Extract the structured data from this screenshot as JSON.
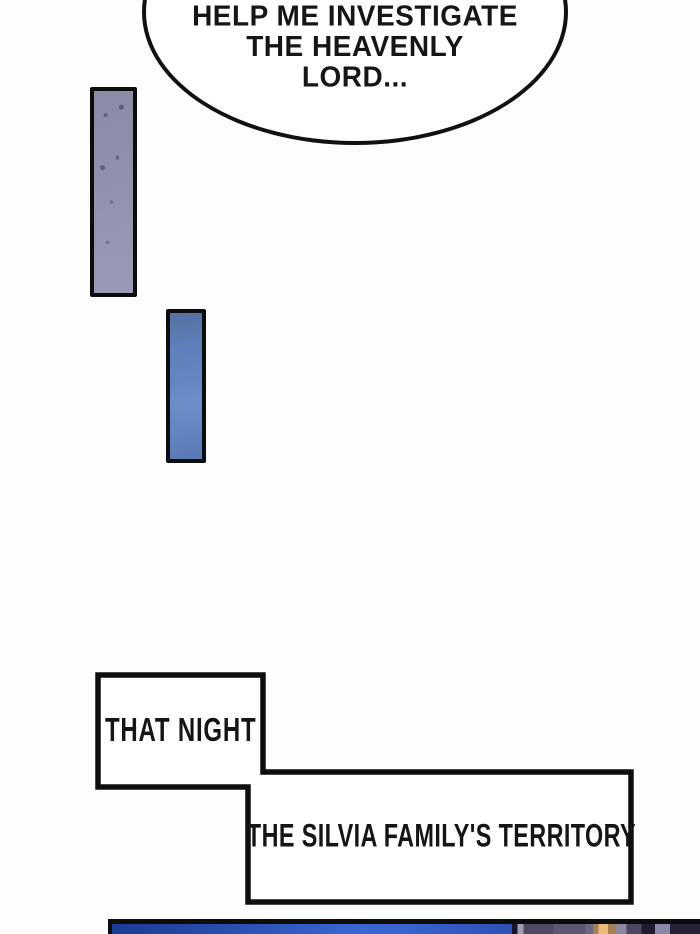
{
  "colors": {
    "ink": "#111111",
    "paper": "#fdfdfd",
    "panel1_fill": "#9191ac",
    "panel2_fill": "#6387c3",
    "night_blue": "#3c66d2",
    "window_glow": "#edbb74"
  },
  "speech_bubble": {
    "lines": [
      "HELP ME INVESTIGATE",
      "THE HEAVENLY",
      "LORD..."
    ]
  },
  "captions": {
    "that_night": "THAT NIGHT",
    "territory": "THE SILVIA FAMILY'S TERRITORY"
  }
}
